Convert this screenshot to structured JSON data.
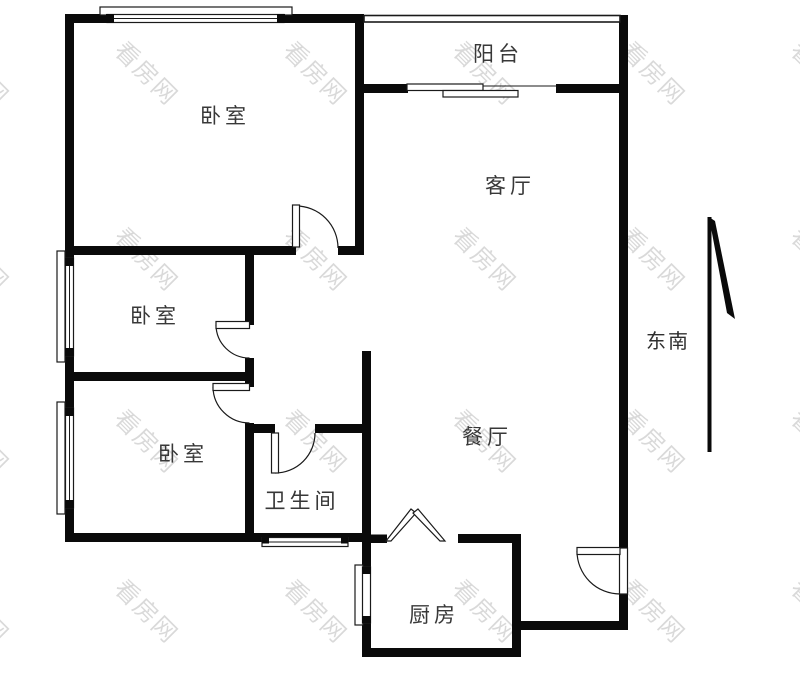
{
  "watermark": {
    "text": "看房网"
  },
  "colors": {
    "wall": "#0a0a0a",
    "label": "#383838",
    "watermark_gray": "#d6d6d6",
    "background": "#ffffff"
  },
  "rooms": {
    "bedroom_top": "卧室",
    "balcony": "阳台",
    "living": "客厅",
    "bedroom_middle": "卧室",
    "bedroom_bottom": "卧室",
    "bathroom": "卫生间",
    "dining": "餐厅",
    "kitchen": "厨房"
  },
  "compass": {
    "label": "东南"
  }
}
